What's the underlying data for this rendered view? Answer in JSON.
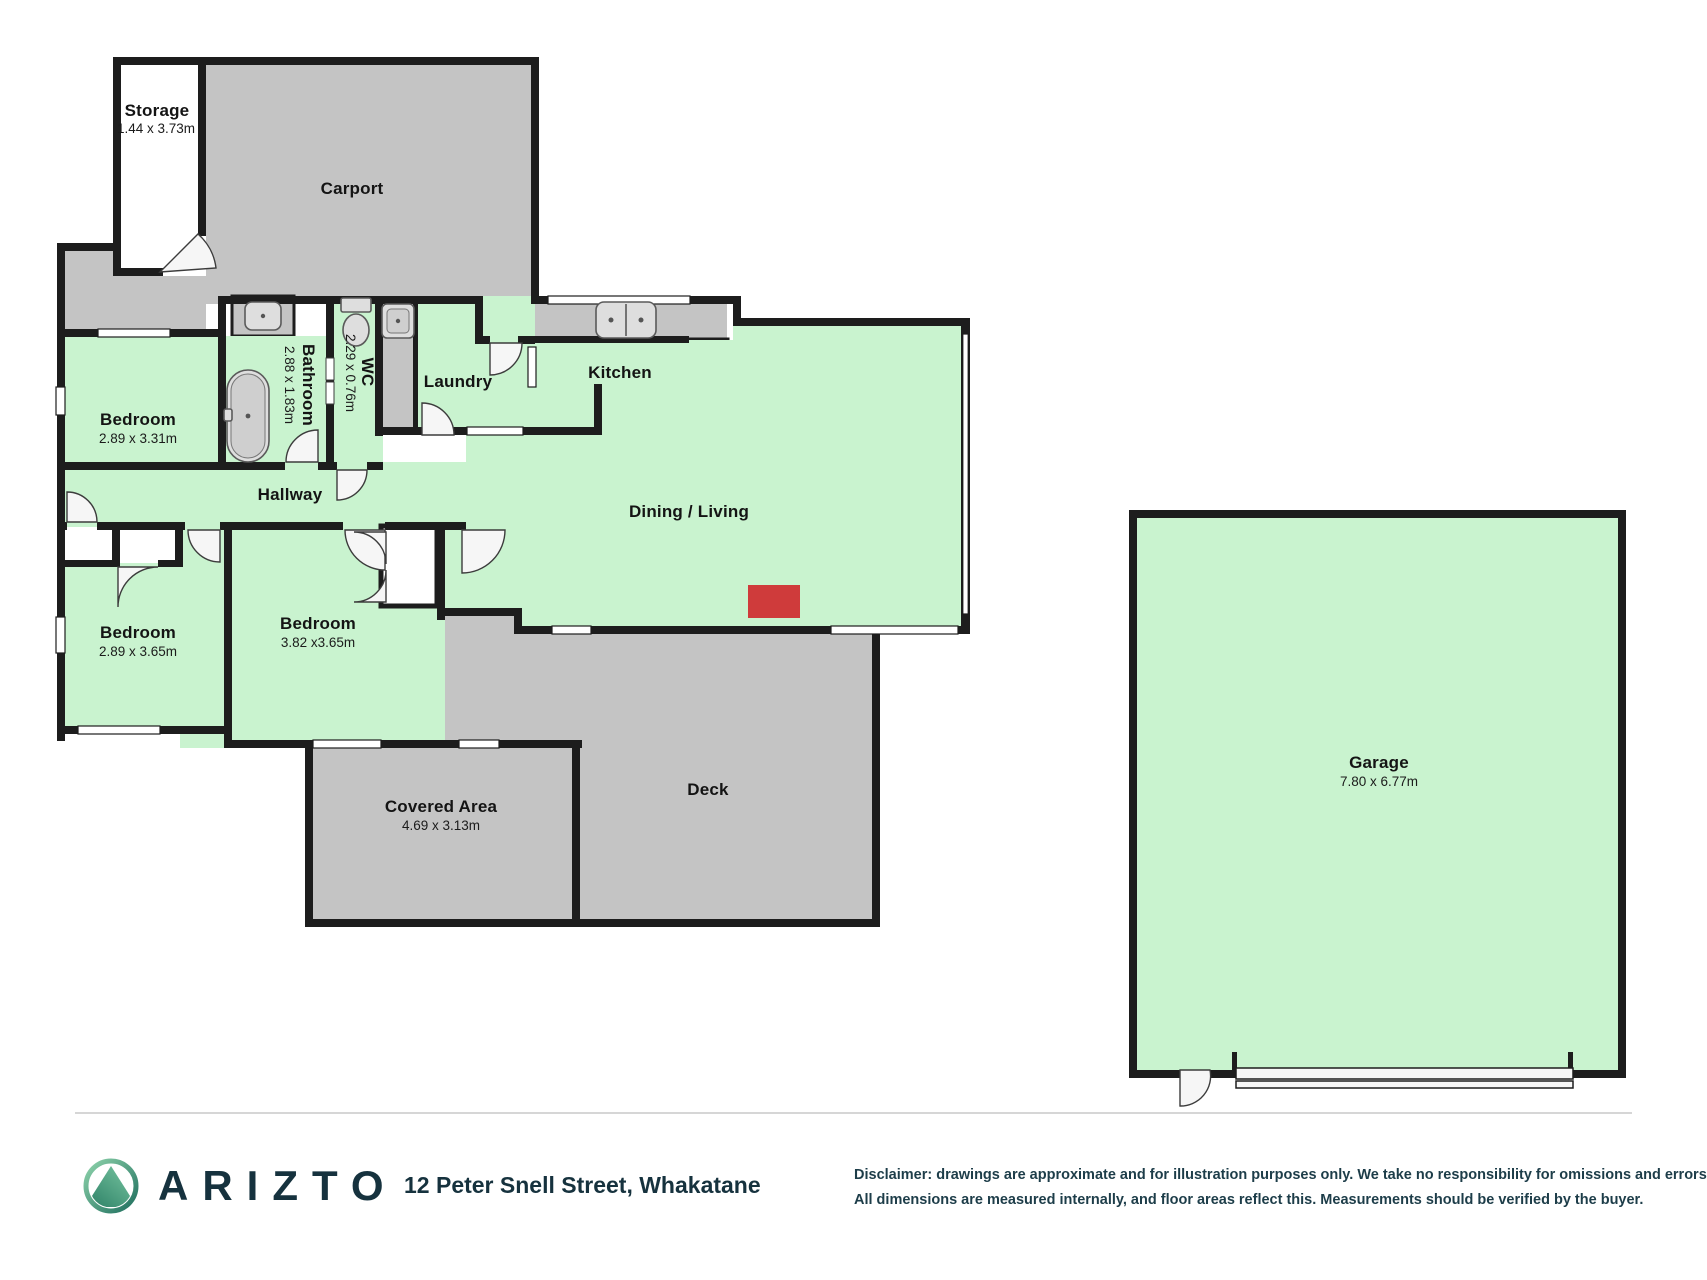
{
  "rooms": {
    "storage": {
      "name": "Storage",
      "dims": "1.44 x 3.73m"
    },
    "carport": {
      "name": "Carport"
    },
    "bedroom1": {
      "name": "Bedroom",
      "dims": "2.89 x 3.31m"
    },
    "bathroom": {
      "name": "Bathroom",
      "dims": "2.88 x 1.83m"
    },
    "wc": {
      "name": "WC",
      "dims": "2.29 x 0.76m"
    },
    "laundry": {
      "name": "Laundry"
    },
    "kitchen": {
      "name": "Kitchen"
    },
    "hallway": {
      "name": "Hallway"
    },
    "dining": {
      "name": "Dining / Living"
    },
    "bedroom2": {
      "name": "Bedroom",
      "dims": "2.89 x 3.65m"
    },
    "bedroom3": {
      "name": "Bedroom",
      "dims": "3.82 x3.65m"
    },
    "covered": {
      "name": "Covered Area",
      "dims": "4.69 x 3.13m"
    },
    "deck": {
      "name": "Deck"
    },
    "garage": {
      "name": "Garage",
      "dims": "7.80 x 6.77m"
    }
  },
  "footer": {
    "brand": "ARIZTO",
    "address": "12 Peter Snell Street, Whakatane",
    "disclaimer_line1": "Disclaimer: drawings are approximate and for illustration purposes only. We take no responsibility for omissions and errors.",
    "disclaimer_line2": "All dimensions are measured internally, and floor areas reflect this. Measurements should be verified by the buyer."
  },
  "colors": {
    "room_green": "#c9f3cf",
    "area_gray": "#c4c4c4",
    "wall": "#1d1d1d",
    "fireplace_red": "#cf3b3b",
    "brand_navy": "#16323e"
  }
}
